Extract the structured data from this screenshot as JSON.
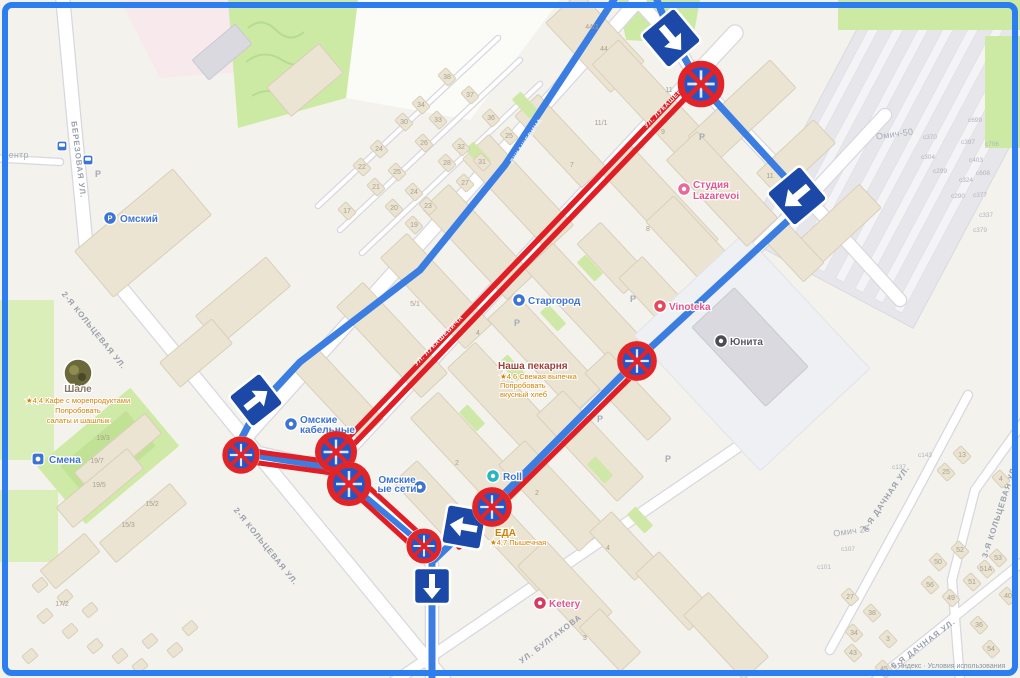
{
  "map": {
    "title": "Схема ограничений движения — карта района",
    "attribution": "© Яндекс · Условия использования",
    "colors": {
      "frame_blue": "#2b7df0",
      "frame_outer": "#16244e",
      "route_blue": "#3b7de0",
      "restriction_red": "#e01e25",
      "sign_blue": "#1c49a8",
      "no_stop_fill": "#2456c8",
      "green": "#cdeaa4",
      "building_beige": "#ece4d2"
    }
  },
  "street_labels": [
    {
      "t": "центр",
      "x": 16,
      "y": 158,
      "rot": 0,
      "cls": "area"
    },
    {
      "t": "БЕРЕЗОВАЯ УЛ.",
      "x": 76,
      "y": 160,
      "rot": 83,
      "cls": "street"
    },
    {
      "t": "2-Я КОЛЬЦЕВАЯ УЛ.",
      "x": 92,
      "y": 332,
      "rot": 51,
      "cls": "street"
    },
    {
      "t": "2-Я КОЛЬЦЕВАЯ УЛ.",
      "x": 264,
      "y": 548,
      "rot": 51,
      "cls": "street"
    },
    {
      "t": "УЛ. ЛУКАШЕВИЧА",
      "x": 670,
      "y": 104,
      "rot": -46,
      "cls": "onred"
    },
    {
      "t": "УЛ. ЛУКАШЕВИЧА",
      "x": 440,
      "y": 342,
      "rot": -46,
      "cls": "onred"
    },
    {
      "t": "ЛУКАШЕВИЧА",
      "x": 528,
      "y": 142,
      "rot": -56,
      "cls": "onblue"
    },
    {
      "t": "УЛ. БУЛГАКОВА",
      "x": 552,
      "y": 641,
      "rot": -37,
      "cls": "street"
    },
    {
      "t": "4-Я ДАЧНАЯ УЛ.",
      "x": 888,
      "y": 500,
      "rot": -56,
      "cls": "street"
    },
    {
      "t": "5-Я ДАЧНАЯ УЛ.",
      "x": 925,
      "y": 646,
      "rot": -37,
      "cls": "street"
    },
    {
      "t": "3-Я КОЛЬЦЕВАЯ УЛ.",
      "x": 1002,
      "y": 512,
      "rot": -72,
      "cls": "street"
    },
    {
      "t": "Омич-50",
      "x": 895,
      "y": 137,
      "rot": -8,
      "cls": "area"
    },
    {
      "t": "Омич 25",
      "x": 852,
      "y": 534,
      "rot": -8,
      "cls": "area"
    }
  ],
  "pois": [
    {
      "name": "Омский",
      "x": 110,
      "y": 218,
      "tx": 120,
      "ty": 222,
      "color": "#3d73d2",
      "icon": "parking-circle-icon",
      "ic": "#3d73d2",
      "letter": "Р"
    },
    {
      "name": "Старгород",
      "x": 519,
      "y": 300,
      "tx": 528,
      "ty": 304,
      "color": "#3d73d2",
      "icon": "restaurant-icon",
      "ic": "#3d73d2"
    },
    {
      "name": "Vinoteka",
      "x": 660,
      "y": 306,
      "tx": 669,
      "ty": 310,
      "color": "#e0568e",
      "icon": "wine-icon",
      "ic": "#e8465a"
    },
    {
      "name": "Юнита",
      "x": 721,
      "y": 341,
      "tx": 730,
      "ty": 345,
      "color": "#5a5a64",
      "icon": "company-icon",
      "ic": "#4c4c55"
    },
    {
      "name": "Ketery",
      "x": 540,
      "y": 603,
      "tx": 549,
      "ty": 607,
      "color": "#e0568e",
      "icon": "cafe-icon",
      "ic": "#d63a60"
    },
    {
      "name": "Roll",
      "x": 493,
      "y": 476,
      "tx": 503,
      "ty": 480,
      "color": "#3d73d2",
      "icon": "shop-icon",
      "ic": "#2ab5c0"
    },
    {
      "name": "Смена",
      "x": 38,
      "y": 459,
      "tx": 49,
      "ty": 463,
      "color": "#3d73d2",
      "icon": "stadium-icon",
      "ic": "#3d73d2",
      "square": 1
    },
    {
      "lines": [
        "Студия",
        "Lazarevoi"
      ],
      "x": 684,
      "y": 189,
      "tx": 693,
      "ty": 188,
      "lh": 11,
      "color": "#e0568e",
      "icon": "beauty-icon",
      "ic": "#e86a9a"
    },
    {
      "lines": [
        "Омские",
        "кабельные"
      ],
      "x": 291,
      "y": 424,
      "tx": 300,
      "ty": 423,
      "lh": 10,
      "color": "#3d73d2",
      "icon": "factory-icon",
      "ic": "#3d73d2"
    },
    {
      "lines": [
        "Омские",
        "ые сети"
      ],
      "x": 420,
      "y": 487,
      "tx": 397,
      "ty": 483,
      "lh": 9,
      "color": "#3d73d2",
      "anchor": "middle",
      "icon": "factory-icon",
      "ic": "#3d73d2"
    },
    {
      "name": "Наша пекарня",
      "tx": 498,
      "ty": 369,
      "color": "#a2403a",
      "sub": [
        "★4,6 Свежая выпечка",
        "Попробовать",
        "вкусный хлеб"
      ],
      "sx": 500,
      "sy": 379,
      "slh": 9
    },
    {
      "name": "Шале",
      "tx": 78,
      "ty": 392,
      "anchor": "middle",
      "color": "#857a68",
      "icon": "photo-icon",
      "x": 78,
      "y": 373,
      "r": 14,
      "sub": [
        "★4,4 Кафе с морепродуктами",
        "Попробовать",
        "салаты и шашлык"
      ],
      "sx": 78,
      "sy": 403,
      "slh": 10,
      "sanchor": "middle"
    },
    {
      "name": "ЕДА",
      "tx": 495,
      "ty": 536,
      "color": "#d07f00",
      "sub": [
        "★4,7 Пышечная"
      ],
      "sx": 490,
      "sy": 545
    }
  ],
  "signs": [
    {
      "type": "one-way",
      "x": 671,
      "y": 38,
      "size": 44,
      "rot": -40
    },
    {
      "type": "no-stopping",
      "x": 701,
      "y": 84,
      "r": 22
    },
    {
      "type": "one-way",
      "x": 797,
      "y": 196,
      "size": 44,
      "rot": 50
    },
    {
      "type": "one-way",
      "x": 256,
      "y": 400,
      "size": 40,
      "rot": -128
    },
    {
      "type": "no-stopping",
      "x": 241,
      "y": 455,
      "r": 18
    },
    {
      "type": "no-stopping",
      "x": 336,
      "y": 452,
      "r": 20
    },
    {
      "type": "no-stopping",
      "x": 349,
      "y": 484,
      "r": 21
    },
    {
      "type": "no-stopping",
      "x": 637,
      "y": 361,
      "r": 19
    },
    {
      "type": "one-way",
      "x": 464,
      "y": 527,
      "size": 40,
      "rot": 100
    },
    {
      "type": "no-stopping",
      "x": 424,
      "y": 546,
      "r": 17
    },
    {
      "type": "no-stopping",
      "x": 492,
      "y": 507,
      "r": 19
    },
    {
      "type": "one-way",
      "x": 432,
      "y": 586,
      "size": 36,
      "rot": 0
    }
  ],
  "house_numbers": [
    [
      "38",
      447,
      76,
      1
    ],
    [
      "37",
      470,
      94,
      1
    ],
    [
      "34",
      421,
      104,
      1
    ],
    [
      "33",
      438,
      119,
      1
    ],
    [
      "36",
      491,
      117,
      1
    ],
    [
      "30",
      404,
      121,
      1
    ],
    [
      "25",
      509,
      135,
      1
    ],
    [
      "26",
      424,
      142,
      1
    ],
    [
      "32",
      461,
      146,
      1
    ],
    [
      "24",
      379,
      148,
      1
    ],
    [
      "28",
      447,
      162,
      1
    ],
    [
      "31",
      482,
      161,
      1
    ],
    [
      "22",
      362,
      166,
      1
    ],
    [
      "25",
      397,
      171,
      1
    ],
    [
      "27",
      465,
      182,
      1
    ],
    [
      "21",
      376,
      186,
      1
    ],
    [
      "24",
      414,
      191,
      1
    ],
    [
      "23",
      428,
      205,
      1
    ],
    [
      "20",
      394,
      207,
      1
    ],
    [
      "17",
      347,
      210,
      1
    ],
    [
      "19",
      414,
      224,
      1
    ],
    [
      "44/1",
      592,
      26,
      0
    ],
    [
      "44",
      604,
      48,
      0
    ],
    [
      "11",
      669,
      89,
      0
    ],
    [
      "11/1",
      601,
      122,
      0
    ],
    [
      "7",
      572,
      164,
      0
    ],
    [
      "9",
      663,
      131,
      0
    ],
    [
      "8",
      648,
      228,
      0
    ],
    [
      "11",
      770,
      175,
      0
    ],
    [
      "5/1",
      415,
      303,
      0
    ],
    [
      "4",
      478,
      332,
      0
    ],
    [
      "2",
      537,
      492,
      0
    ],
    [
      "4",
      608,
      547,
      0
    ],
    [
      "3",
      585,
      637,
      0
    ],
    [
      "2",
      457,
      462,
      0
    ],
    [
      "19/3",
      103,
      437,
      0
    ],
    [
      "19/7",
      97,
      460,
      0
    ],
    [
      "19/5",
      99,
      484,
      0
    ],
    [
      "15/2",
      152,
      503,
      0
    ],
    [
      "15/3",
      128,
      524,
      0
    ],
    [
      "17/2",
      62,
      603,
      0
    ],
    [
      "13",
      962,
      454,
      1
    ],
    [
      "25",
      946,
      471,
      1
    ],
    [
      "4",
      1001,
      478,
      1
    ],
    [
      "52",
      960,
      549,
      1
    ],
    [
      "53",
      998,
      557,
      1
    ],
    [
      "50",
      938,
      561,
      1
    ],
    [
      "51А",
      986,
      568,
      1
    ],
    [
      "51",
      972,
      581,
      1
    ],
    [
      "56",
      930,
      584,
      1
    ],
    [
      "40",
      1008,
      595,
      1
    ],
    [
      "49",
      951,
      597,
      1
    ],
    [
      "27",
      850,
      596,
      1
    ],
    [
      "38",
      872,
      612,
      1
    ],
    [
      "36",
      979,
      624,
      1
    ],
    [
      "34",
      854,
      632,
      1
    ],
    [
      "3",
      888,
      638,
      1
    ],
    [
      "54",
      991,
      648,
      1
    ],
    [
      "43",
      853,
      652,
      1
    ],
    [
      "45",
      884,
      668,
      1
    ]
  ],
  "plot_numbers": [
    [
      "с699",
      975,
      120
    ],
    [
      "с370",
      930,
      137
    ],
    [
      "с397",
      968,
      142
    ],
    [
      "с706",
      992,
      144
    ],
    [
      "с304",
      928,
      157
    ],
    [
      "с403",
      976,
      160
    ],
    [
      "с299",
      940,
      171
    ],
    [
      "с608",
      983,
      173
    ],
    [
      "с324",
      966,
      180
    ],
    [
      "с290",
      958,
      196
    ],
    [
      "с377",
      980,
      195
    ],
    [
      "с337",
      986,
      215
    ],
    [
      "с379",
      980,
      230
    ],
    [
      "с143",
      925,
      455
    ],
    [
      "с137",
      899,
      467
    ],
    [
      "с107",
      848,
      549
    ],
    [
      "с101",
      824,
      567
    ]
  ],
  "parking_marks": [
    [
      98,
      174
    ],
    [
      517,
      323
    ],
    [
      633,
      299
    ],
    [
      702,
      137
    ],
    [
      600,
      419
    ],
    [
      810,
      206
    ],
    [
      668,
      459
    ]
  ],
  "bus_stops": [
    [
      62,
      146
    ],
    [
      88,
      160
    ],
    [
      249,
      392
    ]
  ]
}
